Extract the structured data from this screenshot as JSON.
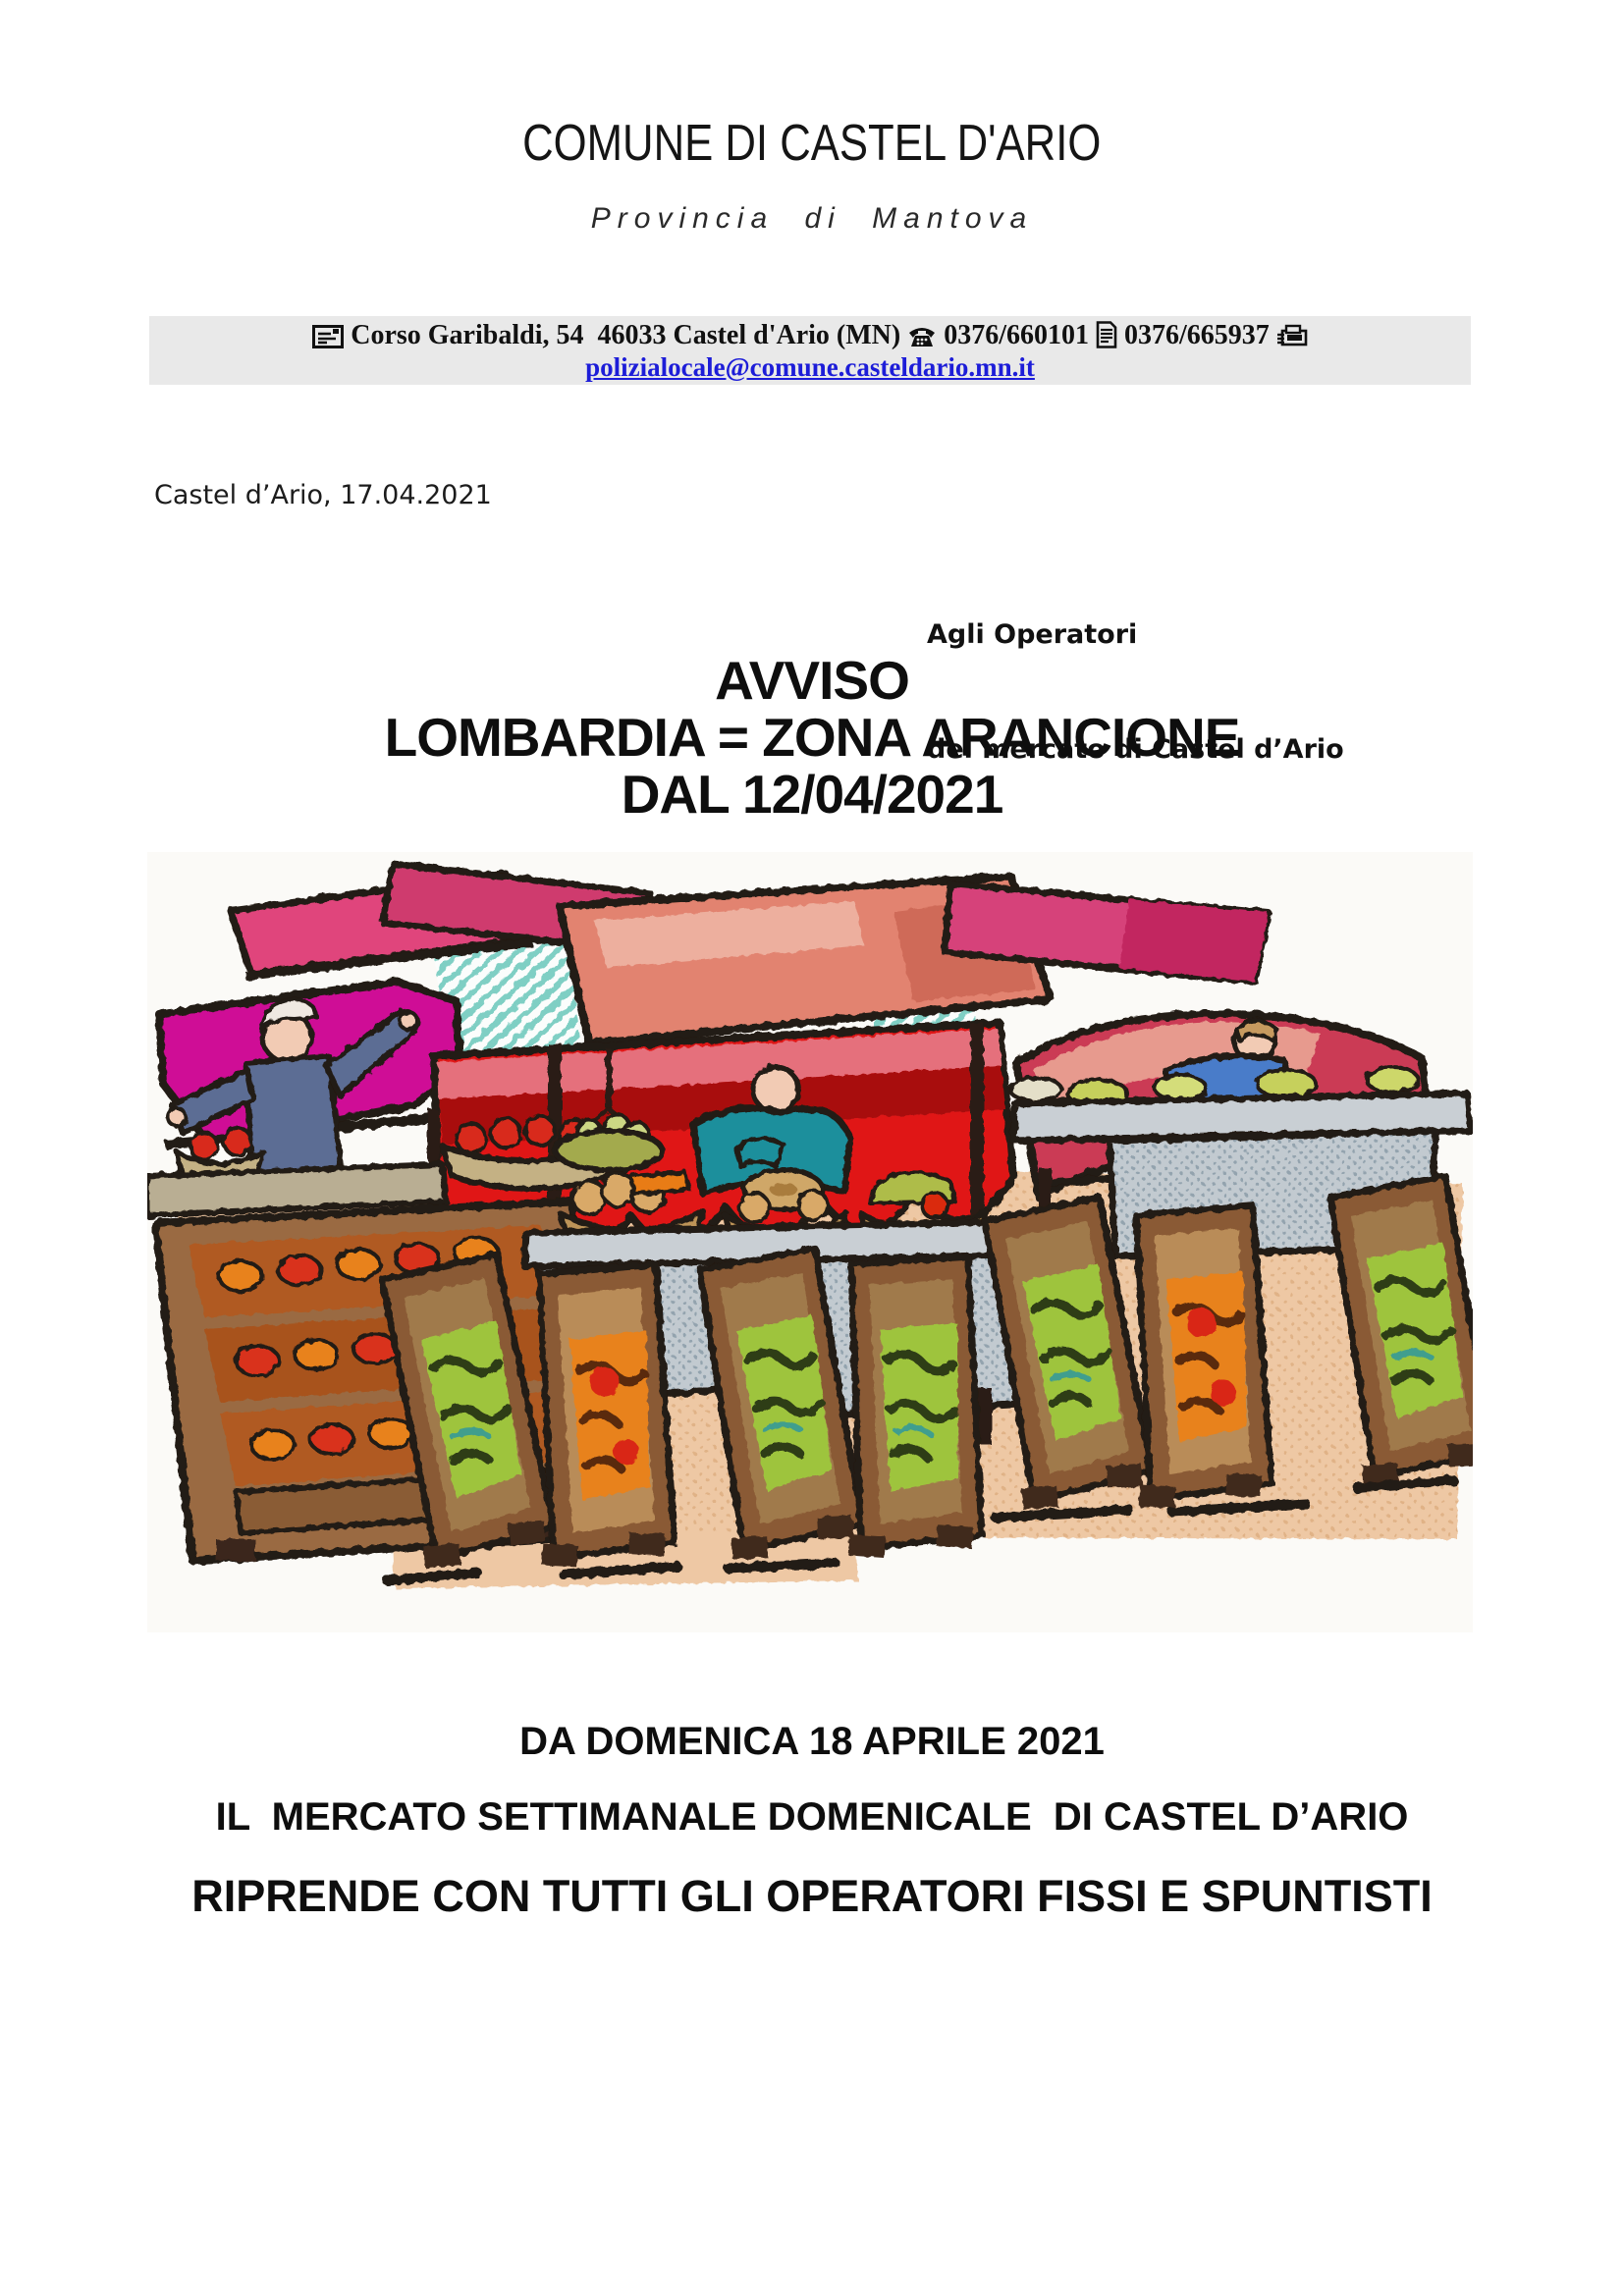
{
  "header": {
    "title": "COMUNE DI CASTEL D'ARIO",
    "subtitle": "Provincia di Mantova"
  },
  "banner": {
    "address": "Corso Garibaldi, 54  46033 Castel d'Ario (MN)",
    "phone_number": "0376/660101",
    "fax_number": "0376/665937",
    "email": "polizialocale@comune.casteldario.mn.it",
    "icons": [
      "envelope-icon",
      "phone-icon",
      "document-icon",
      "fax-icon"
    ]
  },
  "dateline": "Castel d’Ario, 17.04.2021",
  "recipient": {
    "line1": "Agli Operatori",
    "line2": "del mercato di Castel d’Ario"
  },
  "notice": {
    "line1": "AVVISO",
    "line2": "LOMBARDIA = ZONA ARANCIONE",
    "line3": "DAL 12/04/2021"
  },
  "illustration": {
    "description": "Clipart of an open-air street market: three stalls with pink, red and magenta awnings, vendors behind grey tables, baskets of bread and fruit, and leaning wooden crates of green and orange produce"
  },
  "footer": {
    "line1": "DA DOMENICA 18 APRILE 2021",
    "line2": "IL  MERCATO SETTIMANALE DOMENICALE  DI CASTEL D’ARIO",
    "line3": "RIPRENDE CON TUTTI GLI OPERATORI FISSI E SPUNTISTI"
  },
  "colors": {
    "banner_bg": "#e9e9e9",
    "email_blue": "#1d1dd8",
    "awning_red": "#e01717",
    "awning_magenta": "#cf0d96",
    "awning_pink": "#d6437a",
    "wall_peach": "#eec8a4"
  }
}
